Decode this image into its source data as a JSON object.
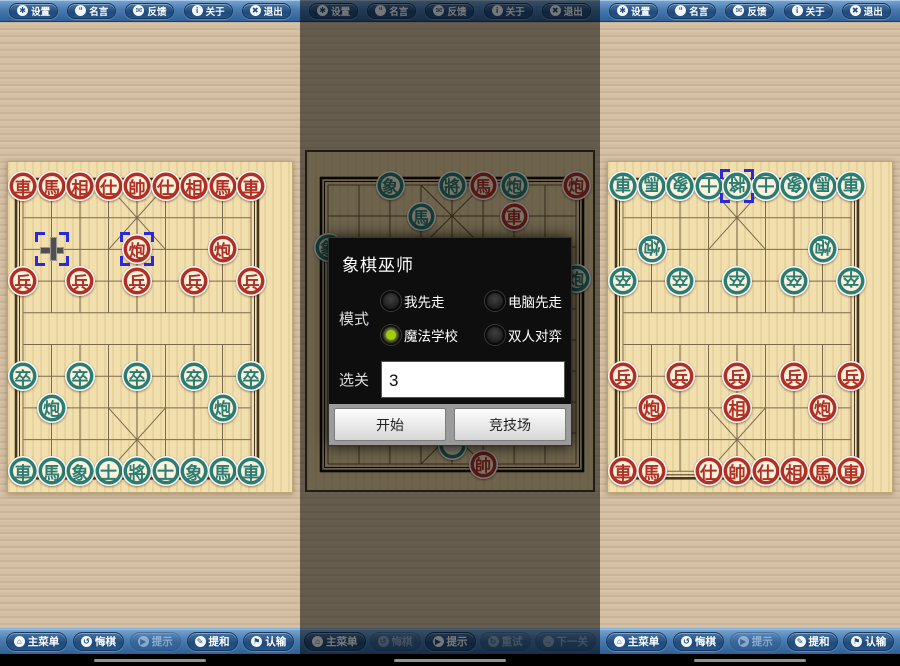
{
  "colors": {
    "piece_red": "#b13025",
    "piece_teal": "#2c7c72",
    "selection_blue": "#2a2ad8",
    "radio_green": "#a3cb06",
    "toolbar_blue": "#3a6da3",
    "dialog_bg": "#0e0e0e",
    "board_tan": "#f2dfae"
  },
  "icon_glyphs": {
    "gear-icon": "✱",
    "speech-icon": "“",
    "mail-icon": "✉",
    "info-icon": "i",
    "exit-icon": "✖",
    "home-icon": "⌂",
    "undo-icon": "↺",
    "hint-icon": "▶",
    "retry-icon": "↻",
    "next-icon": "→",
    "pencil-icon": "✎",
    "flag-icon": "⚑"
  },
  "top_toolbar": {
    "buttons": [
      {
        "id": "settings",
        "label": "设置",
        "icon": "gear-icon",
        "enabled": true
      },
      {
        "id": "quotes",
        "label": "名言",
        "icon": "speech-icon",
        "enabled": true
      },
      {
        "id": "feedback",
        "label": "反馈",
        "icon": "mail-icon",
        "enabled": true
      },
      {
        "id": "about",
        "label": "关于",
        "icon": "info-icon",
        "enabled": true
      },
      {
        "id": "exit",
        "label": "退出",
        "icon": "exit-icon",
        "enabled": true
      }
    ]
  },
  "dialog": {
    "title": "象棋巫师",
    "mode_label": "模式",
    "radios": [
      {
        "label": "我先走",
        "selected": false
      },
      {
        "label": "电脑先走",
        "selected": false
      },
      {
        "label": "魔法学校",
        "selected": true
      },
      {
        "label": "双人对弈",
        "selected": false
      }
    ],
    "level_label": "选关",
    "level_value": "3",
    "start_label": "开始",
    "arena_label": "竞技场"
  },
  "panels": [
    {
      "name": "game-board-left",
      "dimmed": false,
      "bottom_toolbar": [
        {
          "id": "main-menu",
          "label": "主菜单",
          "icon": "home-icon",
          "enabled": true
        },
        {
          "id": "undo",
          "label": "悔棋",
          "icon": "undo-icon",
          "enabled": true
        },
        {
          "id": "hint",
          "label": "提示",
          "icon": "hint-icon",
          "enabled": false
        },
        {
          "id": "offer-draw",
          "label": "提和",
          "icon": "pencil-icon",
          "enabled": true
        },
        {
          "id": "resign",
          "label": "认输",
          "icon": "flag-icon",
          "enabled": true
        }
      ],
      "board": {
        "theme": "light",
        "flip_teal": false,
        "pieces": [
          {
            "r": 0,
            "c": 0,
            "ch": "車",
            "s": "r"
          },
          {
            "r": 0,
            "c": 1,
            "ch": "馬",
            "s": "r"
          },
          {
            "r": 0,
            "c": 2,
            "ch": "相",
            "s": "r"
          },
          {
            "r": 0,
            "c": 3,
            "ch": "仕",
            "s": "r"
          },
          {
            "r": 0,
            "c": 4,
            "ch": "帥",
            "s": "r"
          },
          {
            "r": 0,
            "c": 5,
            "ch": "仕",
            "s": "r"
          },
          {
            "r": 0,
            "c": 6,
            "ch": "相",
            "s": "r"
          },
          {
            "r": 0,
            "c": 7,
            "ch": "馬",
            "s": "r"
          },
          {
            "r": 0,
            "c": 8,
            "ch": "車",
            "s": "r"
          },
          {
            "r": 2,
            "c": 4,
            "ch": "炮",
            "s": "r",
            "sel": true
          },
          {
            "r": 2,
            "c": 7,
            "ch": "炮",
            "s": "r"
          },
          {
            "r": 3,
            "c": 0,
            "ch": "兵",
            "s": "r"
          },
          {
            "r": 3,
            "c": 2,
            "ch": "兵",
            "s": "r"
          },
          {
            "r": 3,
            "c": 4,
            "ch": "兵",
            "s": "r"
          },
          {
            "r": 3,
            "c": 6,
            "ch": "兵",
            "s": "r"
          },
          {
            "r": 3,
            "c": 8,
            "ch": "兵",
            "s": "r"
          },
          {
            "r": 6,
            "c": 0,
            "ch": "卒",
            "s": "t"
          },
          {
            "r": 6,
            "c": 2,
            "ch": "卒",
            "s": "t"
          },
          {
            "r": 6,
            "c": 4,
            "ch": "卒",
            "s": "t"
          },
          {
            "r": 6,
            "c": 6,
            "ch": "卒",
            "s": "t"
          },
          {
            "r": 6,
            "c": 8,
            "ch": "卒",
            "s": "t"
          },
          {
            "r": 7,
            "c": 1,
            "ch": "炮",
            "s": "t"
          },
          {
            "r": 7,
            "c": 7,
            "ch": "炮",
            "s": "t"
          },
          {
            "r": 9,
            "c": 0,
            "ch": "車",
            "s": "t"
          },
          {
            "r": 9,
            "c": 1,
            "ch": "馬",
            "s": "t"
          },
          {
            "r": 9,
            "c": 2,
            "ch": "象",
            "s": "t"
          },
          {
            "r": 9,
            "c": 3,
            "ch": "士",
            "s": "t"
          },
          {
            "r": 9,
            "c": 4,
            "ch": "將",
            "s": "t"
          },
          {
            "r": 9,
            "c": 5,
            "ch": "士",
            "s": "t"
          },
          {
            "r": 9,
            "c": 6,
            "ch": "象",
            "s": "t"
          },
          {
            "r": 9,
            "c": 7,
            "ch": "馬",
            "s": "t"
          },
          {
            "r": 9,
            "c": 8,
            "ch": "車",
            "s": "t"
          }
        ],
        "markers": [
          {
            "r": 2,
            "c": 1,
            "cursor": true
          }
        ]
      }
    },
    {
      "name": "level-select",
      "dimmed": true,
      "bottom_toolbar": [
        {
          "id": "main-menu",
          "label": "主菜单",
          "icon": "home-icon",
          "enabled": true
        },
        {
          "id": "undo",
          "label": "悔棋",
          "icon": "undo-icon",
          "enabled": false
        },
        {
          "id": "hint",
          "label": "提示",
          "icon": "hint-icon",
          "enabled": true
        },
        {
          "id": "retry",
          "label": "重试",
          "icon": "retry-icon",
          "enabled": false
        },
        {
          "id": "next-level",
          "label": "下一关",
          "icon": "next-icon",
          "enabled": false
        }
      ],
      "board": {
        "theme": "classic",
        "flip_teal": false,
        "pieces": [
          {
            "r": 0,
            "c": 2,
            "ch": "象",
            "s": "t"
          },
          {
            "r": 0,
            "c": 4,
            "ch": "將",
            "s": "t"
          },
          {
            "r": 0,
            "c": 5,
            "ch": "馬",
            "s": "r"
          },
          {
            "r": 0,
            "c": 6,
            "ch": "炮",
            "s": "t"
          },
          {
            "r": 0,
            "c": 8,
            "ch": "炮",
            "s": "r"
          },
          {
            "r": 1,
            "c": 3,
            "ch": "馬",
            "s": "t"
          },
          {
            "r": 1,
            "c": 6,
            "ch": "車",
            "s": "r"
          },
          {
            "r": 2,
            "c": 0,
            "ch": "象",
            "s": "t"
          },
          {
            "r": 3,
            "c": 8,
            "ch": "炮",
            "s": "t"
          },
          {
            "r": 8.4,
            "c": 4,
            "ch": "",
            "s": "t"
          },
          {
            "r": 9,
            "c": 5,
            "ch": "帥",
            "s": "r"
          }
        ],
        "markers": []
      }
    },
    {
      "name": "game-board-right",
      "dimmed": false,
      "bottom_toolbar": [
        {
          "id": "main-menu",
          "label": "主菜单",
          "icon": "home-icon",
          "enabled": true
        },
        {
          "id": "undo",
          "label": "悔棋",
          "icon": "undo-icon",
          "enabled": true
        },
        {
          "id": "hint",
          "label": "提示",
          "icon": "hint-icon",
          "enabled": false
        },
        {
          "id": "offer-draw",
          "label": "提和",
          "icon": "pencil-icon",
          "enabled": true
        },
        {
          "id": "resign",
          "label": "认输",
          "icon": "flag-icon",
          "enabled": true
        }
      ],
      "board": {
        "theme": "light",
        "flip_teal": true,
        "pieces": [
          {
            "r": 0,
            "c": 0,
            "ch": "車",
            "s": "t"
          },
          {
            "r": 0,
            "c": 1,
            "ch": "馬",
            "s": "t"
          },
          {
            "r": 0,
            "c": 2,
            "ch": "象",
            "s": "t"
          },
          {
            "r": 0,
            "c": 3,
            "ch": "士",
            "s": "t"
          },
          {
            "r": 0,
            "c": 4,
            "ch": "將",
            "s": "t",
            "sel": true
          },
          {
            "r": 0,
            "c": 5,
            "ch": "士",
            "s": "t"
          },
          {
            "r": 0,
            "c": 6,
            "ch": "象",
            "s": "t"
          },
          {
            "r": 0,
            "c": 7,
            "ch": "馬",
            "s": "t"
          },
          {
            "r": 0,
            "c": 8,
            "ch": "車",
            "s": "t"
          },
          {
            "r": 2,
            "c": 1,
            "ch": "炮",
            "s": "t"
          },
          {
            "r": 2,
            "c": 7,
            "ch": "炮",
            "s": "t"
          },
          {
            "r": 3,
            "c": 0,
            "ch": "卒",
            "s": "t"
          },
          {
            "r": 3,
            "c": 2,
            "ch": "卒",
            "s": "t"
          },
          {
            "r": 3,
            "c": 4,
            "ch": "卒",
            "s": "t"
          },
          {
            "r": 3,
            "c": 6,
            "ch": "卒",
            "s": "t"
          },
          {
            "r": 3,
            "c": 8,
            "ch": "卒",
            "s": "t"
          },
          {
            "r": 6,
            "c": 0,
            "ch": "兵",
            "s": "r"
          },
          {
            "r": 6,
            "c": 2,
            "ch": "兵",
            "s": "r"
          },
          {
            "r": 6,
            "c": 4,
            "ch": "兵",
            "s": "r"
          },
          {
            "r": 6,
            "c": 6,
            "ch": "兵",
            "s": "r"
          },
          {
            "r": 6,
            "c": 8,
            "ch": "兵",
            "s": "r"
          },
          {
            "r": 7,
            "c": 1,
            "ch": "炮",
            "s": "r"
          },
          {
            "r": 7,
            "c": 4,
            "ch": "相",
            "s": "r"
          },
          {
            "r": 7,
            "c": 7,
            "ch": "炮",
            "s": "r"
          },
          {
            "r": 9,
            "c": 0,
            "ch": "車",
            "s": "r"
          },
          {
            "r": 9,
            "c": 1,
            "ch": "馬",
            "s": "r"
          },
          {
            "r": 9,
            "c": 3,
            "ch": "仕",
            "s": "r"
          },
          {
            "r": 9,
            "c": 4,
            "ch": "帥",
            "s": "r"
          },
          {
            "r": 9,
            "c": 5,
            "ch": "仕",
            "s": "r"
          },
          {
            "r": 9,
            "c": 6,
            "ch": "相",
            "s": "r"
          },
          {
            "r": 9,
            "c": 7,
            "ch": "馬",
            "s": "r"
          },
          {
            "r": 9,
            "c": 8,
            "ch": "車",
            "s": "r"
          }
        ],
        "markers": []
      }
    }
  ]
}
